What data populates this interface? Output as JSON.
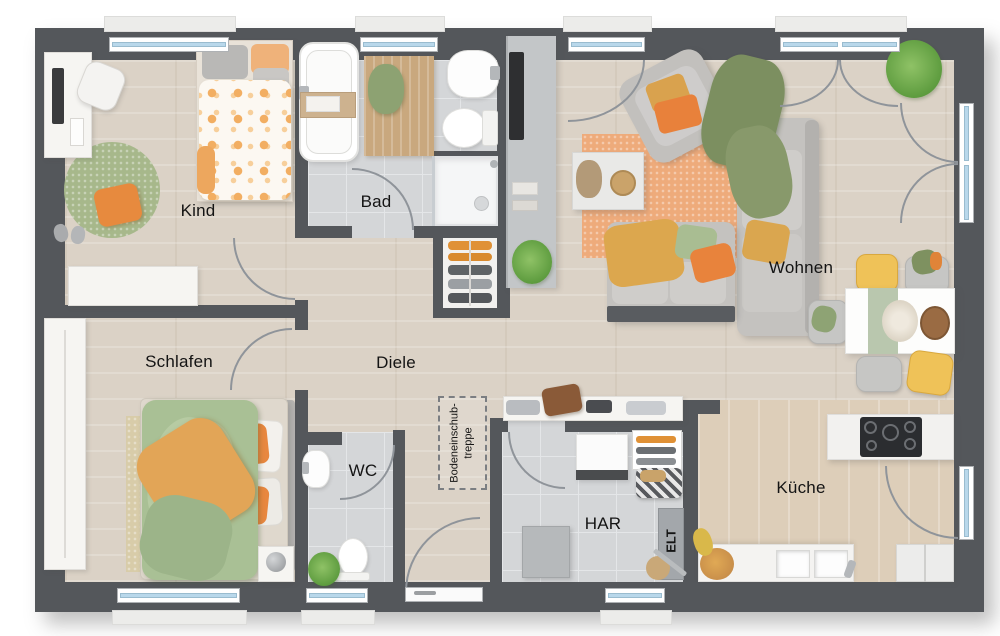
{
  "rooms": {
    "kind": {
      "label": "Kind"
    },
    "bad": {
      "label": "Bad"
    },
    "wohnen": {
      "label": "Wohnen"
    },
    "schlafen": {
      "label": "Schlafen"
    },
    "diele": {
      "label": "Diele"
    },
    "wc": {
      "label": "WC"
    },
    "har": {
      "label": "HAR"
    },
    "kueche": {
      "label": "Küche"
    }
  },
  "annotations": {
    "attic_stairs_line1": "Bodeneinschub-",
    "attic_stairs_line2": "treppe",
    "electrical": "ELT"
  },
  "colors": {
    "wall": "#54575b",
    "wood_floor": "#dbd2c6",
    "kitchen_floor": "#ddceb9",
    "tile_floor": "#d4d6d8",
    "window_glass": "#b9d8eb",
    "accent_orange": "#e8873f",
    "accent_yellow": "#efc258",
    "accent_green": "#9fb387",
    "rug_orange": "#eeab7b",
    "label_text": "#141414"
  }
}
